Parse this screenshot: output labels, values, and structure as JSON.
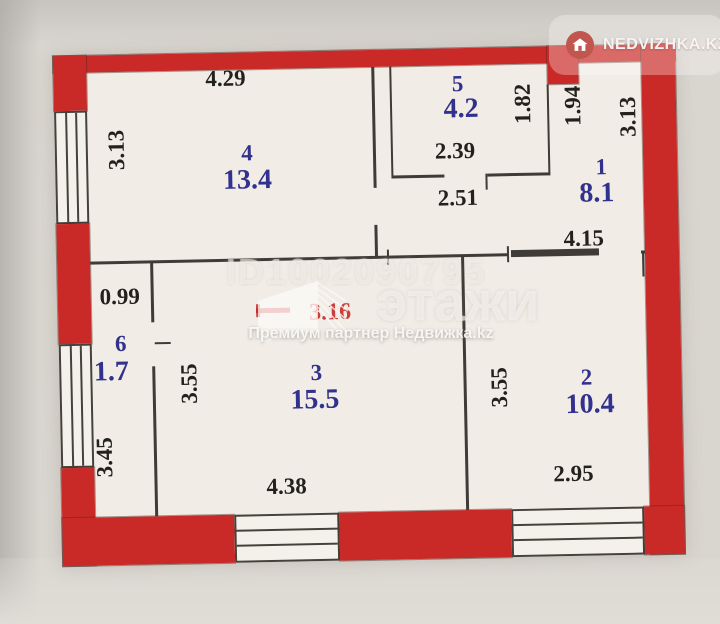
{
  "badge": {
    "label": "NEDVIZHKA.KZ"
  },
  "watermark": {
    "id": "ID1002090795",
    "brand": "этажи",
    "subtitle": "Премиум партнер Недвижка.kz"
  },
  "annotation": {
    "red_note": "3.16"
  },
  "colors": {
    "wall_red": "#c92a27",
    "label_blue": "#32318d",
    "ink": "#23211e",
    "note_red": "#c42020",
    "paper": "#f1ede6"
  },
  "rooms": [
    {
      "id": "4",
      "area": "13.4"
    },
    {
      "id": "5",
      "area": "4.2"
    },
    {
      "id": "1",
      "area": "8.1"
    },
    {
      "id": "6",
      "area": "1.7"
    },
    {
      "id": "3",
      "area": "15.5"
    },
    {
      "id": "2",
      "area": "10.4"
    }
  ],
  "dims": {
    "top_width": "4.29",
    "room4_height": "3.13",
    "room5_width": "2.39",
    "room5_height": "1.82",
    "hall_width": "2.51",
    "room1_height_left": "1.94",
    "room1_height_right": "3.13",
    "room1_width": "4.15",
    "room6_width": "0.99",
    "room6_height": "3.45",
    "room3_height": "3.55",
    "room3_width": "4.38",
    "room2_height": "3.55",
    "room2_width": "2.95"
  }
}
